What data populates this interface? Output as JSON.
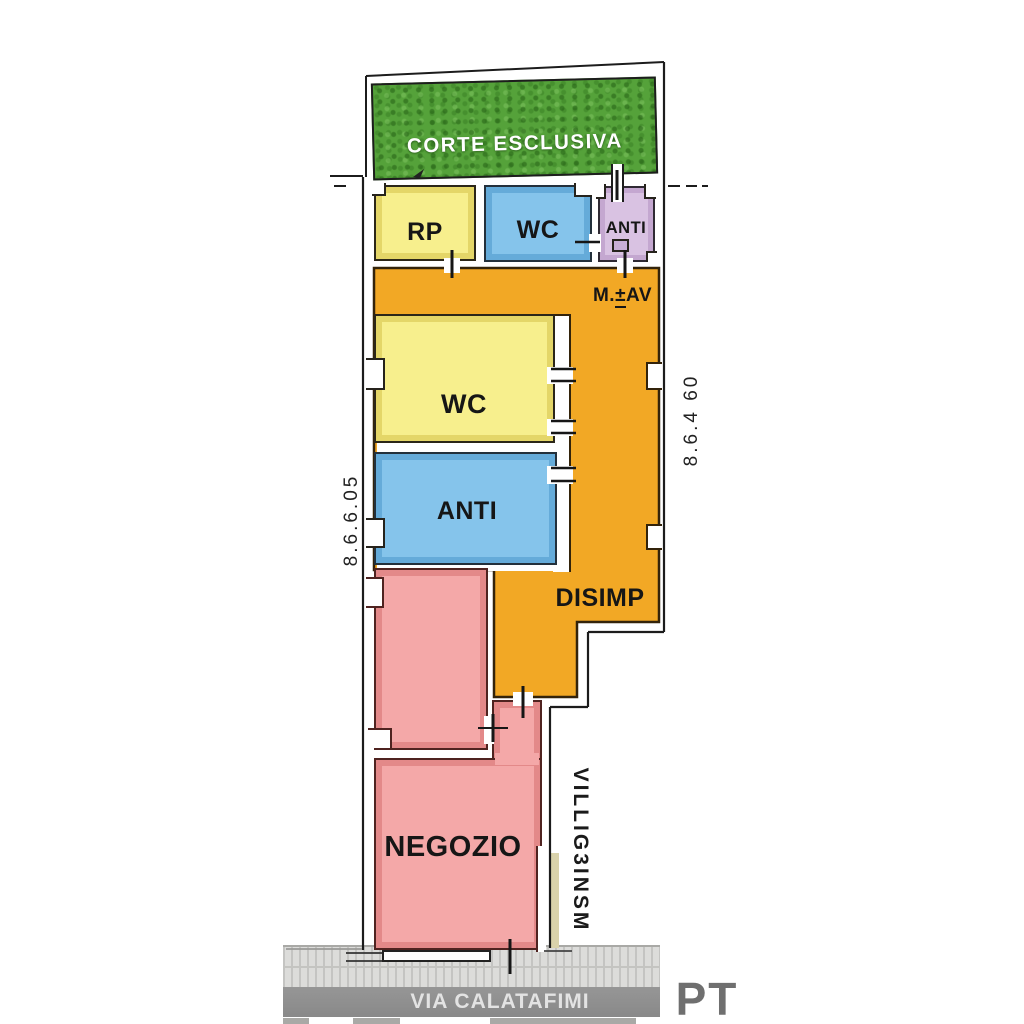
{
  "plan": {
    "corte_label": "CORTE ESCLUSIVA",
    "rooms": {
      "rp": "RP",
      "wc_top": "WC",
      "anti_top": "ANTI",
      "wc_main": "WC",
      "anti_main": "ANTI",
      "disimp": "DISIMP",
      "negozio": "NEGOZIO"
    },
    "annotations": {
      "mav_prefix": "M.",
      "mav_symbol": "±",
      "mav_suffix": "AV",
      "dim_left": "8.6.6.05",
      "dim_right": "8.6.4 60",
      "side_text": "VILLIG3INSM"
    },
    "street_label": "VIA CALATAFIMI",
    "floor_label": "PT",
    "colors": {
      "grass": "#55a23a",
      "yellow": "#f7ef8d",
      "blue": "#85c4eb",
      "purple": "#d9c2e2",
      "orange": "#f2a825",
      "pink": "#f4a8a8",
      "street": "#8e8e8e",
      "sidewalk": "#dcdcda"
    }
  }
}
